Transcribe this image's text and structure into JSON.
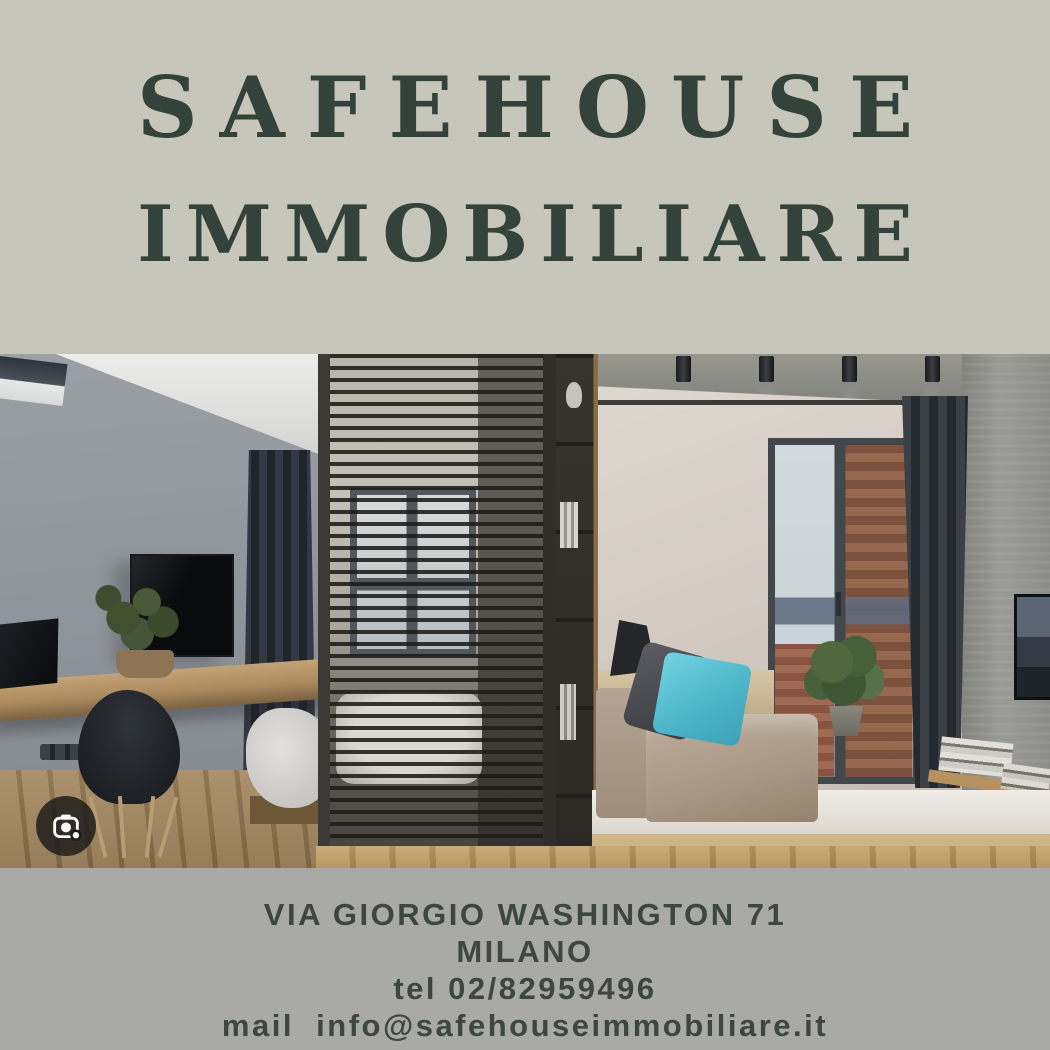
{
  "colors": {
    "canvas_top": "#c6c7ba",
    "canvas_bottom": "#a9a9a7",
    "title_text": "#33423a",
    "footer_text": "#3d463f",
    "accent_pillow": "#52c0d2"
  },
  "header": {
    "title_line1": "SAFEHOUSE",
    "title_line2": "IMMOBILIARE"
  },
  "photo": {
    "description": "Modern studio apartment interior: gray wall with TV and desk, wooden slat partition with bed and window behind it, shelf unit, beige daybed with turquoise cushion, balcony door with brick wall and city view, dark curtains, concrete wall with TV",
    "lens_icon": "camera-lens-icon"
  },
  "footer": {
    "address_line": "VIA GIORGIO WASHINGTON 71",
    "city_line": "MILANO",
    "phone_line": "tel 02/82959496",
    "email_line": "mail  info@safehouseimmobiliare.it"
  }
}
